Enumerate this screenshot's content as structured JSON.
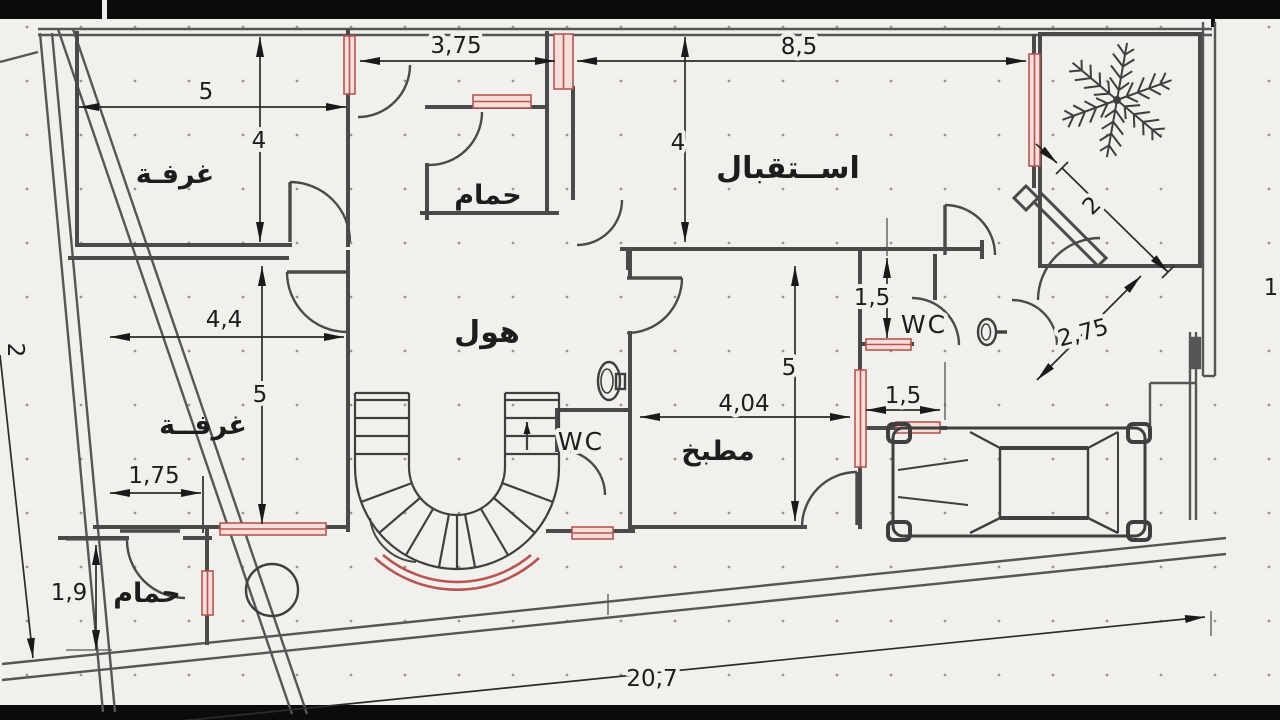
{
  "plan": {
    "rooms": {
      "room_top_left": "غرفـة",
      "bath_top": "حمام",
      "reception": "اســتقبال",
      "hall": "هول",
      "room_mid_left": "غرفــة",
      "kitchen": "مطبخ",
      "bath_bottom": "حمام",
      "wc_center": "WC",
      "wc_right": "WC"
    },
    "dims": {
      "room1_w": "5",
      "room1_h": "4",
      "entry_w": "3,75",
      "reception_w": "8,5",
      "reception_h": "4",
      "room2_w": "4,4",
      "room2_h": "5",
      "room2_closet": "1,75",
      "bath2_h": "1,9",
      "kitchen_w": "4,04",
      "kitchen_h": "5",
      "wc_right_h": "1,5",
      "passage_w": "1,5",
      "entrance_diag": "2",
      "entrance_diag2": "2,75",
      "right_side": "1",
      "plot_w": "20,7",
      "left_edge": "2"
    },
    "icons": {
      "tree": "plant-icon",
      "car": "car-top-view-icon",
      "toilet": "toilet-icon",
      "staircase": "spiral-stair-icon",
      "column": "column-circle-icon"
    },
    "colors": {
      "wall": "#4a4a4a",
      "window_stroke": "#b85550",
      "window_fill": "#f6dedb",
      "background": "#f2f0ec",
      "frame_bar": "#0b0b0b"
    }
  }
}
